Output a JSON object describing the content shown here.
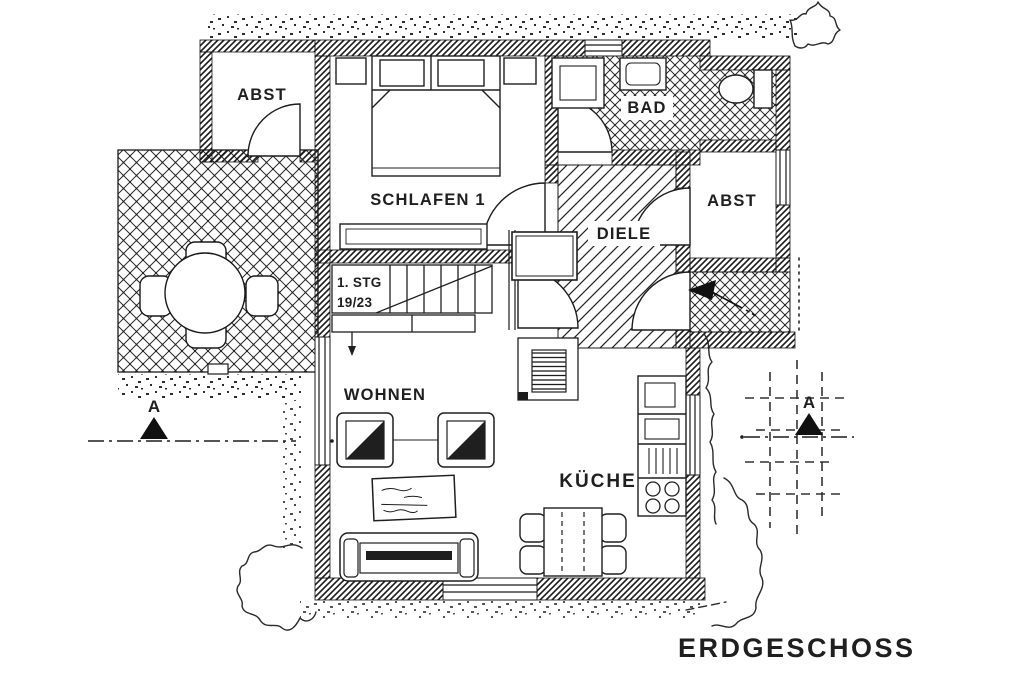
{
  "plan": {
    "title": "ERDGESCHOSS",
    "rooms": {
      "abst_left": {
        "label": "ABST"
      },
      "schlafen": {
        "label": "SCHLAFEN 1"
      },
      "bad": {
        "label": "BAD"
      },
      "diele": {
        "label": "DIELE"
      },
      "abst_right": {
        "label": "ABST"
      },
      "wohnen": {
        "label": "WOHNEN"
      },
      "kueche": {
        "label": "KÜCHE"
      }
    },
    "stairs": {
      "note_line1": "1. STG",
      "note_line2": "19/23"
    },
    "section_markers": {
      "left": "A",
      "right": "A"
    },
    "colors": {
      "ink": "#1f1f1f",
      "paper": "#ffffff"
    }
  }
}
